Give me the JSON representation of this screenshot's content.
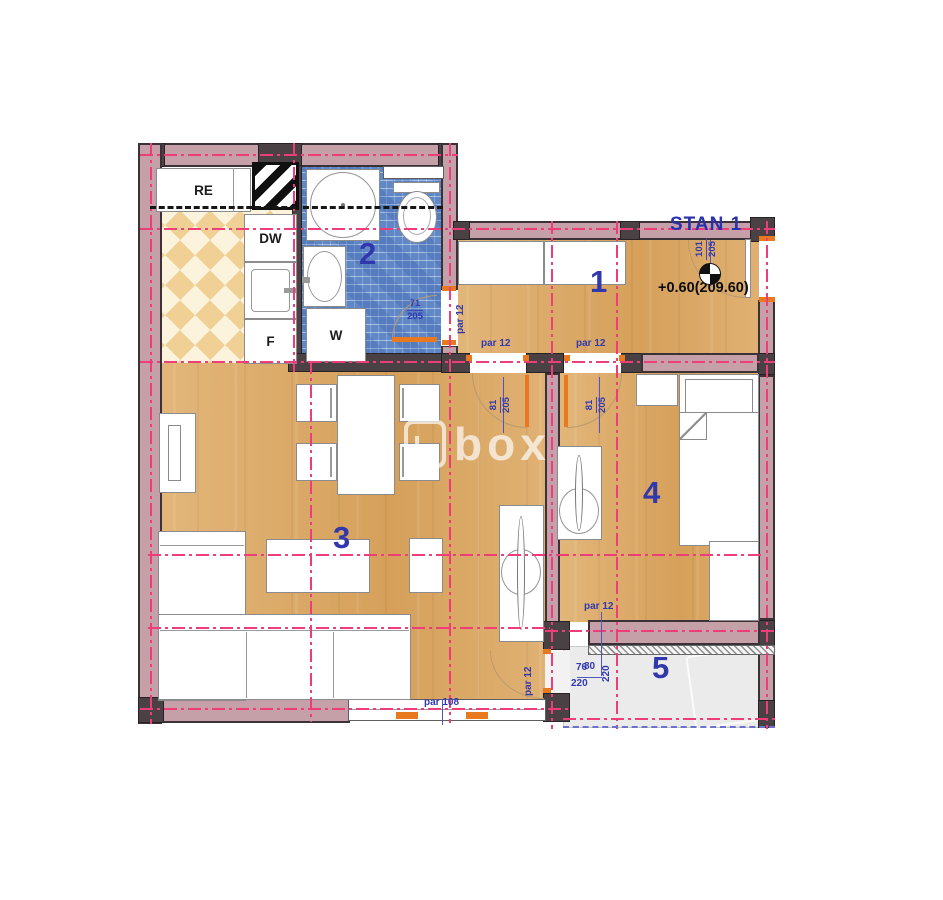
{
  "plan": {
    "title": "STAN 1",
    "elevation_label": "+0.60(209.60)",
    "watermark_text": "box",
    "rooms": {
      "hallway": "1",
      "bathroom": "2",
      "living_room": "3",
      "bedroom": "4",
      "balcony": "5"
    },
    "appliances": {
      "refrigerator": "RE",
      "dishwasher": "DW",
      "freezer": "F",
      "washing_machine": "W"
    },
    "dimensions": {
      "par_12": "par 12",
      "par_108": "par 108",
      "door_bath_width": "71",
      "door_room_width": "81",
      "door_entry_width": "101",
      "door_height": "205",
      "balcony_width_a": "76",
      "balcony_width_b": "80",
      "balcony_height": "220"
    },
    "colors": {
      "wall_fill": "#c5a0a9",
      "wall_dark": "#4a4145",
      "centerline": "#ee3d78",
      "dimension_text": "#3239ae",
      "wood_floor": "#d9a45f",
      "bathroom_tile": "#7197cd",
      "kitchen_checker": "#f1d095",
      "balcony_floor": "#ebebec",
      "door_marker": "#e8791f"
    }
  }
}
